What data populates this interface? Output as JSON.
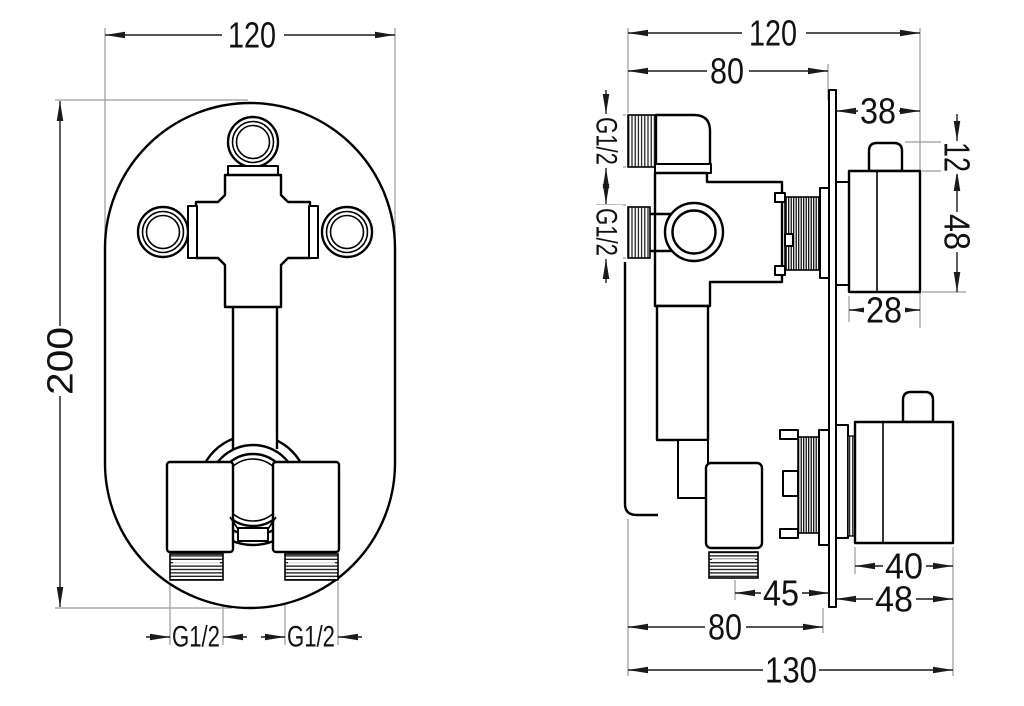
{
  "front_view": {
    "width": "120",
    "height": "200",
    "outlet_left": "G1/2",
    "outlet_right": "G1/2"
  },
  "side_view": {
    "total_width": "120",
    "body_depth": "80",
    "plate_front": "38",
    "inlet_top": "G1/2",
    "inlet_side": "G1/2",
    "stem_height": "12",
    "knob1_height": "48",
    "knob1_width": "28",
    "knob2_width": "40",
    "knob2_depth": "48",
    "outlet_offset": "45",
    "rear_depth": "80",
    "total_depth": "130"
  },
  "colors": {
    "line": "#000000",
    "dimension": "#1a1a1a",
    "extension": "#9a9a9a",
    "background": "#ffffff"
  }
}
